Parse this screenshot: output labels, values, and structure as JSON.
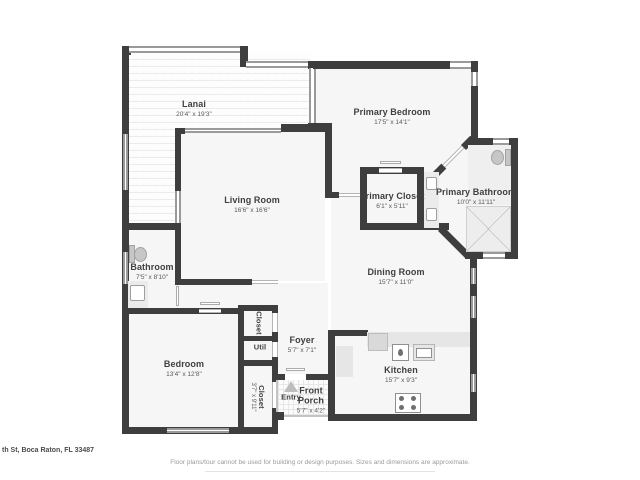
{
  "rooms": {
    "lanai": {
      "name": "Lanai",
      "dims": "20'4\" x 19'3\""
    },
    "primary_bedroom": {
      "name": "Primary Bedroom",
      "dims": "17'5\" x 14'1\""
    },
    "living_room": {
      "name": "Living Room",
      "dims": "16'6\" x 16'6\""
    },
    "primary_closet": {
      "name": "Primary Closet",
      "dims": "6'1\" x 5'11\""
    },
    "primary_bathroom": {
      "name": "Primary Bathroom",
      "dims": "10'0\" x 11'11\""
    },
    "bathroom": {
      "name": "Bathroom",
      "dims": "7'5\" x 8'10\""
    },
    "dining_room": {
      "name": "Dining Room",
      "dims": "15'7\" x 11'0\""
    },
    "bedroom": {
      "name": "Bedroom",
      "dims": "13'4\" x 12'8\""
    },
    "hall_closet": {
      "name": "Closet"
    },
    "util": {
      "name": "Util"
    },
    "bedroom_closet": {
      "name": "Closet",
      "dims": "3'7\" x 9'11\""
    },
    "foyer": {
      "name": "Foyer",
      "dims": "5'7\" x 7'1\""
    },
    "front_porch": {
      "name": "Front Porch",
      "dims": "5'7\" x 4'2\""
    },
    "kitchen": {
      "name": "Kitchen",
      "dims": "15'7\" x 9'3\""
    },
    "entry": {
      "name": "Entry"
    }
  },
  "footer": {
    "address": "th St, Boca Raton, FL 33487",
    "disclaimer": "Floor plans/tour cannot be used for building or design purposes. Sizes and dimensions are approximate."
  },
  "colors": {
    "wall": "#3e3e3e",
    "room_fill": "#f6f6f6",
    "fixture_fill": "#e6e6e6",
    "label_text": "#404040"
  }
}
